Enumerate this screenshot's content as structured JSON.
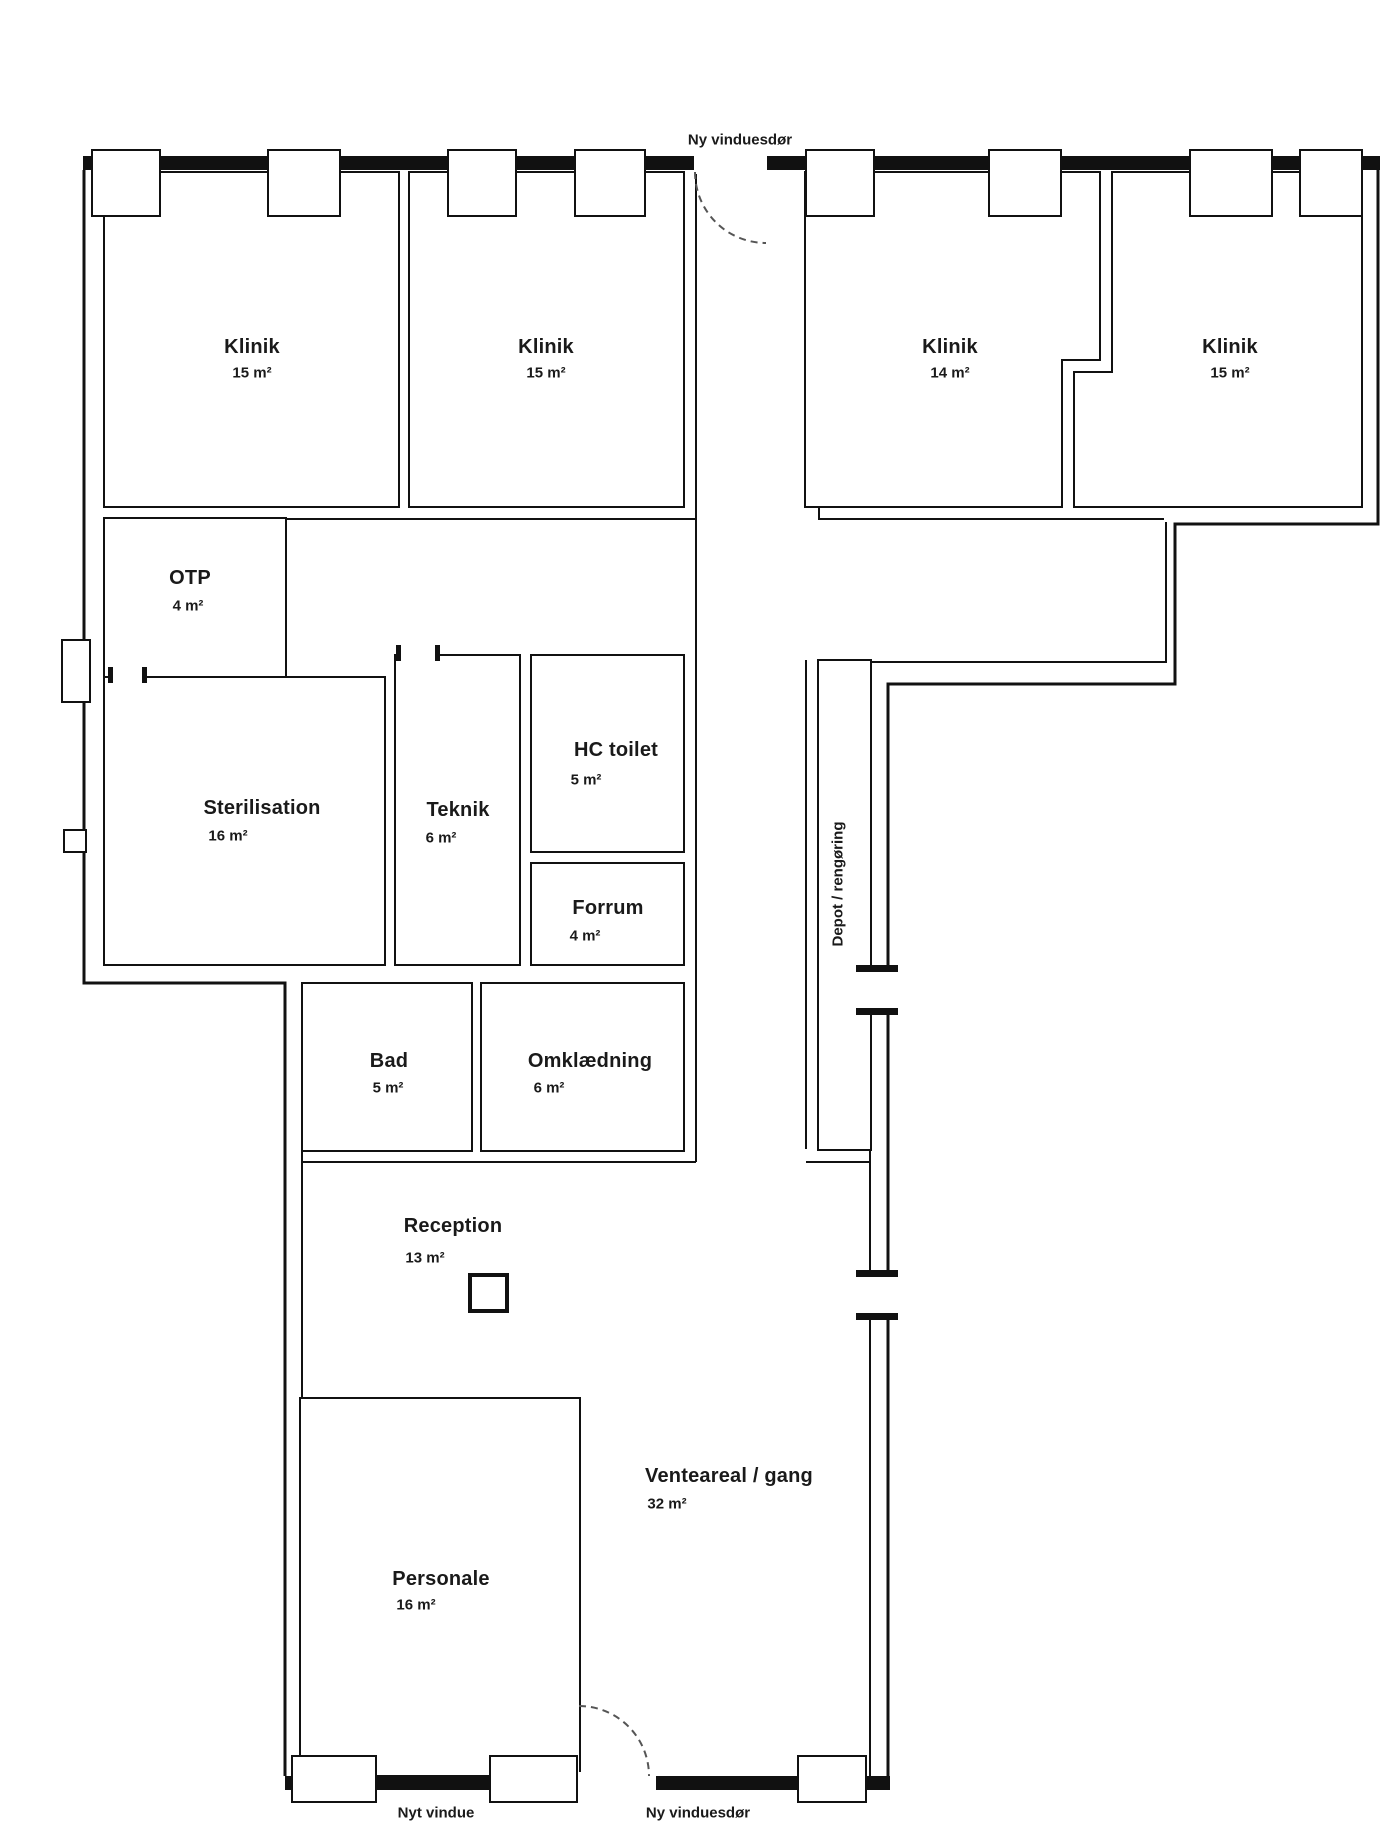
{
  "plan": {
    "top_annotation": "Ny vinduesdør",
    "bottom_annotation_window": "Nyt vindue",
    "bottom_annotation_door": "Ny vinduesdør"
  },
  "rooms": [
    {
      "id": "klinik-1",
      "name": "Klinik",
      "area": "15 m²"
    },
    {
      "id": "klinik-2",
      "name": "Klinik",
      "area": "15 m²"
    },
    {
      "id": "klinik-3",
      "name": "Klinik",
      "area": "14 m²"
    },
    {
      "id": "klinik-4",
      "name": "Klinik",
      "area": "15 m²"
    },
    {
      "id": "otp",
      "name": "OTP",
      "area": "4 m²"
    },
    {
      "id": "sterilisation",
      "name": "Sterilisation",
      "area": "16 m²"
    },
    {
      "id": "teknik",
      "name": "Teknik",
      "area": "6 m²"
    },
    {
      "id": "hc-toilet",
      "name": "HC toilet",
      "area": "5 m²"
    },
    {
      "id": "forrum",
      "name": "Forrum",
      "area": "4 m²"
    },
    {
      "id": "bad",
      "name": "Bad",
      "area": "5 m²"
    },
    {
      "id": "omklaedning",
      "name": "Omklædning",
      "area": "6 m²"
    },
    {
      "id": "reception",
      "name": "Reception",
      "area": "13 m²"
    },
    {
      "id": "personale",
      "name": "Personale",
      "area": "16 m²"
    },
    {
      "id": "venteareal",
      "name": "Venteareal / gang",
      "area": "32 m²"
    },
    {
      "id": "depot",
      "name": "Depot / rengøring",
      "area": ""
    }
  ],
  "colors": {
    "wall": "#111111",
    "background": "#ffffff",
    "text": "#1a1a1a"
  }
}
